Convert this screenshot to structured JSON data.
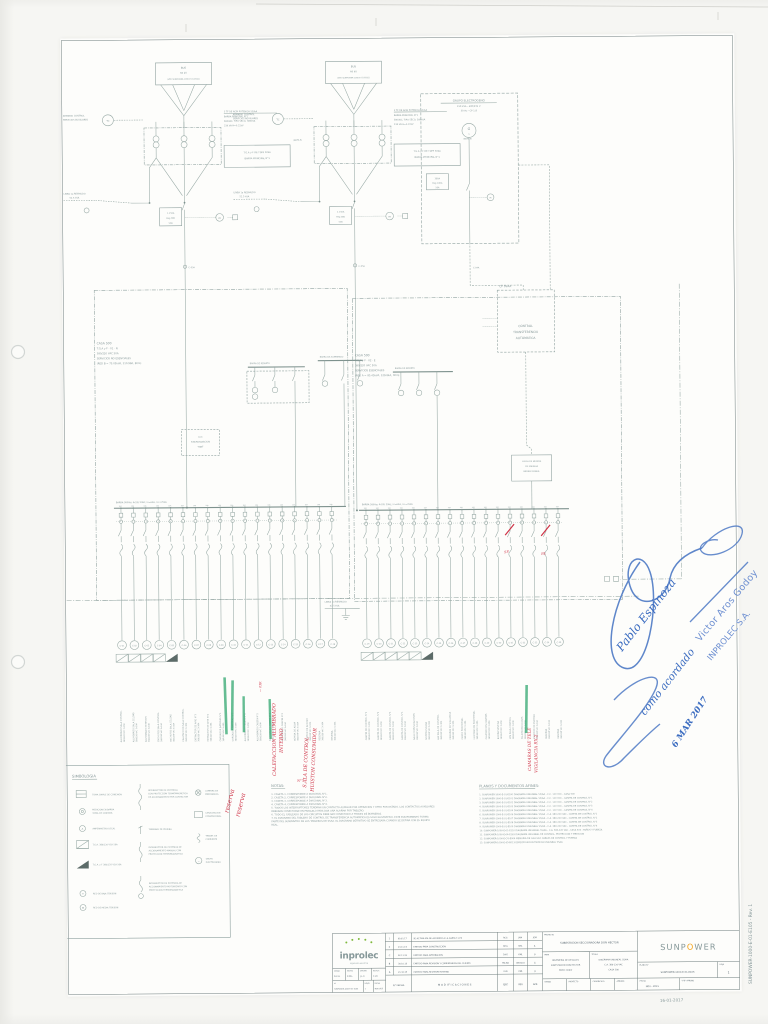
{
  "meta": {
    "corner_date": "16-01-2017",
    "side_code": "SUNPOWER-1000-E-01-E105  -  Rev. 1"
  },
  "tx": {
    "bus1": "BUS",
    "bus2": "66 kV",
    "bus3": "(VER SUNPOWER-1000-E-01-E001)",
    "ctrl1": "ARMARIO CONTROL",
    "ctrl2": "SERVICIOS AUXILIARES",
    "tc": "TC",
    "r1": "3 TF DE ALTA POTENCIA SS/AA",
    "r2": "BARRA PRINCIPAL N°1",
    "r3": "380VAC, TIPO SECO, 380kVA",
    "r4": "23K VA  H=0.22kV",
    "tga1": "T.G.A y F DE TDPF 50kA",
    "tga2": "BARRA PRINCIPAL N°1",
    "nota": "(NOTA 5)",
    "linea1": "LINEA 1a RESPALDO",
    "linea2": "52.5 kVA",
    "meter": "Wh",
    "rating1": [
      "1.150A",
      "Reg 380",
      "50A"
    ],
    "rating2": [
      "2.150A",
      "Reg 380",
      "50A"
    ],
    "tag1": "C-05A",
    "tag2": "C-05A"
  },
  "gen": {
    "l1": "GRUPO ELECTROGENO",
    "l2": "150 kVA - 400/231 V",
    "l3": "50 Hz - CP 1.8",
    "g": "G",
    "wave": "~",
    "rating": [
      "380A",
      "Reg 100A",
      "50A"
    ],
    "meter": "M",
    "tag": "C-04A"
  },
  "cp": {
    "tag": "CP  SSAA",
    "l1": "CONTROL",
    "l2": "TRANSFERENCIA",
    "l3": "AUTOMATICA"
  },
  "panels": {
    "left": {
      "l1": "CASA 500",
      "l2": "T.G.A y F - 01 - N",
      "l3": "380/220 VAC 50A",
      "l4": "SERVICIOS NO ESENCIALES",
      "l5": "(RED B = 73.05kVA, 110.98A, 80m)",
      "bus": "BARRA 380Vac 4x50/ 50Hz, In=63A, Icc=25kA",
      "minibus1": "BARRA DE REPARTO",
      "minibus2": "BARRA DE ALUMBRADO",
      "lcc1": "LCC",
      "lcc2": "SINCRONIZACION",
      "lcc3": "TGBT"
    },
    "right": {
      "l1": "CASA 500",
      "l2": "T.G.A y F - 02 - E",
      "l3": "380/220 VAC 50A",
      "l4": "SERVICIOS ESENCIALES",
      "l5": "(RED A = 85.45kVA, 129.84A, 30m)",
      "bus": "BARRA 380Vac 4x50/ 50Hz, In=63A, Icc=25kA",
      "minibus1": "BARRA DE REPARTO",
      "med1": "LLEGA DE MEDIDA",
      "med2": "DE ENERGIA",
      "med3": "BIDIRECCIONAL"
    },
    "bypass1": "LINEA 1a RESPALDO",
    "bypass2": "52.5 kVA"
  },
  "feeders": {
    "volt": "380/220 VAC 3x10A",
    "tap": "10A",
    "left": [
      [
        "C-01",
        "ALUMBRADO SALA CONTROL"
      ],
      [
        "C-02",
        "ALUMBRADO SALA CELDAS"
      ],
      [
        "C-03",
        "ALUMBRADO EXTERIOR"
      ],
      [
        "C-04",
        "ENCHUFES SALA CONTROL"
      ],
      [
        "C-05",
        "ENCHUFES SALA CELDAS"
      ],
      [
        "C-06",
        "CALEFACCION SALA CONTROL"
      ],
      [
        "C-07",
        "EXTRACTOR DE AIRE N°1"
      ],
      [
        "C-08",
        "EXTRACTOR DE AIRE N°2"
      ],
      [
        "C-09",
        "CARGADOR BATERIAS N°1"
      ],
      [
        "C-10",
        "CARGADOR BATERIAS N°2"
      ],
      [
        "C-11",
        "ALUMBRADO CASETA N°1"
      ],
      [
        "C-12",
        "ALUMBRADO CASETA N°2"
      ],
      [
        "C-13",
        "ALUMBRADO CASETA N°3"
      ],
      [
        "C-14",
        "ALUMBRADO CASETA N°4"
      ],
      [
        "C-15",
        "BOMBA DE AGUA"
      ],
      [
        "C-16",
        "PORTON DE ACCESO"
      ],
      [
        "C-17",
        "RESERVA"
      ],
      [
        "C-18",
        "RESERVA"
      ]
    ],
    "right": [
      [
        "C-19",
        "CASETA DE CONTROL N°1"
      ],
      [
        "C-20",
        "CASETA DE CONTROL N°2"
      ],
      [
        "C-21",
        "CASETA DE CONTROL N°3"
      ],
      [
        "C-22",
        "CASETA DE CONTROL N°4"
      ],
      [
        "C-23",
        "SALA COMUNICACIONES"
      ],
      [
        "C-24",
        "SISTEMA SCADA"
      ],
      [
        "C-25",
        "A/A SALA DE CONTROL"
      ],
      [
        "C-26",
        "CAMARAS DE VIGILANCIA"
      ],
      [
        "C-27",
        "CERCO PERIMETRAL"
      ],
      [
        "C-28",
        "ILUMINACION PERIMETRAL"
      ],
      [
        "C-29",
        "CALEFACCION CASETAS"
      ],
      [
        "C-30",
        "BOMBA SENTINA"
      ],
      [
        "C-31",
        "UPS SALA CONTROL"
      ],
      [
        "C-32",
        "TELEPROTECCIONES"
      ],
      [
        "C-33",
        "MEDIDOR DE ENERGIA"
      ],
      [
        "C-34",
        "RESERVA"
      ],
      [
        "C-35",
        "RESERVA"
      ]
    ]
  },
  "legend": {
    "title": "SIMBOLOGIA",
    "items": [
      {
        "lines": [
          "TOMA SIMPLE DE CONEXION"
        ]
      },
      {
        "lines": [
          "MEDICION EN BARRA",
          "TOMA DE CONTROL"
        ]
      },
      {
        "lines": [
          "AMPERIMETRO LOCAL"
        ]
      },
      {
        "lines": [
          "T.G.A. 380/220 VCA 50A"
        ]
      },
      {
        "lines": [
          "T.G.A. y F 380/220 VCA 50A"
        ]
      },
      {
        "lines": [
          "RED DE BAJA TENSION"
        ]
      },
      {
        "lines": [
          "RED DE MEDIA TENSION"
        ]
      },
      {
        "lines": [
          "INTERRUPTOR DE POTENCIA",
          "CON PROTECCION TERMOMAGNETICA",
          "DE ACCIONAMIENTO POR CONTACTOR"
        ]
      },
      {
        "lines": [
          "TERMINAL DE PRUEBA"
        ]
      },
      {
        "lines": [
          "INTERRUPTOR DE POTENCIA DE",
          "ACCIONAMIENTO MANUAL CON",
          "PROTECCION TERMOMAGNETICA"
        ]
      },
      {
        "lines": [
          "INTERRUPTOR DE POTENCIA DE",
          "ACCIONAMIENTO MOTORIZADO CON",
          "PROTECCION TERMOMAGNETICA"
        ]
      },
      {
        "lines": [
          "LAMPARA DE",
          "EMERGENCIA"
        ]
      },
      {
        "lines": [
          "CANALIZACION",
          "CONVENCIONAL"
        ]
      },
      {
        "lines": [
          "TRANSF. DE",
          "CORRIENTE"
        ]
      },
      {
        "lines": [
          "GRUPO",
          "ELECTROGENO"
        ]
      }
    ]
  },
  "notes": {
    "title": "NOTAS:",
    "lines": [
      "1.  CASETA 1, CORRESPONDE A DIAGONAL N°1.",
      "2.  CASETA 2, CORRESPONDE A DIAGONAL N°2.",
      "3.  CASETA 3, CORRESPONDE A DIAGONAL N°3.",
      "4.  CASETA 4, CORRESPONDE A DIAGONAL N°4.",
      "5.  TODOS LOS INTERRUPTORES TENDRAN UN CONTACTO AUXILIAR POR OPERACION Y OTRO POR ESTADO. LOS CONTACTOS AUXILIARES",
      "     DEBERAN CONECTARSE EN PARALELO PARA DAR UNA ALARMA POR TABLERO.",
      "6.  TODO EL CABLEADO DE LOS CIRCUITOS DEBE SER CONECTADO A TRAVES DE BORNERAS.",
      "7.  EL DIAGRAMA DEL TABLERO DE CONTROL DE TRANSFERENCIA AUTOMATICA ES SOLO ILUSTRATIVO. ESTE EQUIPAMIENTO FORMA",
      "     PARTE DEL SUMINISTRO DE LOS TABLEROS DE SSAA. EL DIAGRAMA DEFINITIVO SE ENTREGARA CUANDO SE DEFINA CON EL EQUIPO",
      "     REAL."
    ]
  },
  "planos": {
    "title": "PLANOS Y DOCUMENTOS AFINES:",
    "lines": [
      "1.   SUNPOWER-1000-E-01-E100   DIAGRAMA UNILINEAL SS/AA - C.C. 110 VCC - CASA 500",
      "2.   SUNPOWER-1000-E-01-E101   DIAGRAMA UNILINEAL SS/AA - C.C. 110 VCC - CASETA DE CONTROL N°1",
      "3.   SUNPOWER-1000-E-01-E102   DIAGRAMA UNILINEAL SS/AA - C.C. 110 VCC - CASETA DE CONTROL N°2",
      "4.   SUNPOWER-1000-E-01-E103   DIAGRAMA UNILINEAL SS/AA - C.C. 110 VCC - CASETA DE CONTROL N°3",
      "5.   SUNPOWER-1000-E-01-E104   DIAGRAMA UNILINEAL SS/AA - C.C. 110 VCC - CASETA DE CONTROL N°4",
      "6.   SUNPOWER-1000-E-01-E106   DIAGRAMA UNILINEAL SS/AA - C.A. 380-220 VAC - CASETA DE CONTROL N°1",
      "7.   SUNPOWER-1000-E-01-E107   DIAGRAMA UNILINEAL SS/AA - C.A. 380-220 VAC - CASETA DE CONTROL N°2",
      "8.   SUNPOWER-1000-E-01-E108   DIAGRAMA UNILINEAL SS/AA - C.A. 380-220 VAC - CASETA DE CONTROL N°3",
      "9.   SUNPOWER-1000-E-01-E109   DIAGRAMA UNILINEAL SS/AA - C.A. 380-220 VAC - CASETA DE CONTROL N°4",
      "10. SUNPOWER-1000-E-01-E110   DIAGRAMA UNILINEAL SS/AA - C.A. 380-220 VAC - CASA 500 - PAÑOS Y FUERZA",
      "11. SUNPOWER-1000-E-04-E163   DIAGRAMA UNILINEAL DE CONTROL, PROTECCION Y MEDICION",
      "12. SUNPOWER-1000-E-CG-E004   MEMORIA DE CALCULO CABLES DE CONTROL Y FUERZA",
      "13. SUNPOWER-1000-E-05-E013   ESPECIFICACION TECNICA UNILINEAL SSAA"
    ]
  },
  "titleblock": {
    "revisions": [
      {
        "n": "1",
        "fecha": "09.01.17",
        "desc": "SE ACTUALIZA DE ACUERDO A LA CARTA T-229",
        "ejec": "RCG",
        "rev": "JAM",
        "apr": "JGM"
      },
      {
        "n": "0",
        "fecha": "23.11.15",
        "desc": "EMITIDO PARA CONSTRUCCION",
        "ejec": "DHG",
        "rev": "KML",
        "apr": "JL"
      },
      {
        "n": "C",
        "fecha": "02.11.15",
        "desc": "EMITIDO PARA APROBACION",
        "ejec": "DHG",
        "rev": "KML",
        "apr": "JL"
      },
      {
        "n": "B",
        "fecha": "30.10.15",
        "desc": "EMITIDO PARA REVISION Y COMENTARIOS DEL CLIENTE",
        "ejec": "PALMA",
        "rev": "ANGULO",
        "apr": "JL"
      },
      {
        "n": "A",
        "fecha": "21.10.15",
        "desc": "EMITIDO PARA REVISION INTERNA",
        "ejec": "KLB",
        "rev": "KML",
        "apr": "JL"
      }
    ],
    "header": {
      "nf": "N°  FECHA",
      "mod": "M O D I F I C A C I O N E S",
      "ejec": "EJEC",
      "rev": "REV",
      "apr": "APR"
    },
    "proyecto_label": "PROYECTO",
    "proyecto": "SUBESTACION SECCIONADORA DON HECTOR",
    "para_label": "PARA",
    "para1": "INGENIERIA DE DETALLES",
    "para2": "SUBESTACION DON HECTOR",
    "para3": "PATIO 220kV",
    "titulo_label": "TITULO",
    "titulo1": "DIAGRAMA UNILINEAL SS/AA",
    "titulo2": "C.A. 380-220 VAC",
    "titulo3": "CASA 500",
    "bl1": "DIBUJO",
    "bl2": "PROYECTO",
    "bl3": "CUADRICULA",
    "bl4": "APROBO",
    "plano_label": "PLANO N°",
    "plano": "SUNPOWER-1000-E-01-E105",
    "hoja_label": "HOJA",
    "hoja": "1",
    "fecha_label": "FECHA",
    "fecha": "NOV - 2015",
    "vb_label": "V°B° APROBO",
    "mini": [
      {
        "l": "DIBUJO",
        "v": "R.C.G."
      },
      {
        "l": "REVISO",
        "v": "K.M.L."
      },
      {
        "l": "APROBO",
        "v": "J.L.C."
      },
      {
        "l": "ESCALA",
        "v": "1:20"
      }
    ],
    "mini2": [
      {
        "l": "N°",
        "v": "SUNPOWER-1000-E-01-E105"
      },
      {
        "l": "HOJAS",
        "v": "1"
      },
      {
        "l": "FECHA",
        "v": "NOV.2015"
      }
    ]
  },
  "logos": {
    "inprolec": "inprolec",
    "inprolec_tag": "ingenieria electrica",
    "sun_a": "SUNP",
    "sun_o": "O",
    "sun_b": "WER"
  },
  "red": {
    "res1": "reserva",
    "res2": "reserva",
    "cal1": "CALEFACCION ALUMBRADO",
    "cal2": "INTERNO",
    "tag": "— 03R",
    "sala1": "S.ALA DE CONTROL",
    "sala2": "HUISTON CONSUMIDOR",
    "cam1": "CAMARAS DE TELE",
    "cam2": "VIGILANCIA RX-2",
    "sp": "SP.",
    "bl": "BL",
    "n7": "N°7"
  },
  "stamp": {
    "hand1": "Pablo Espinoza",
    "hand2": "como acordado",
    "name": "Victor Aros Godoy",
    "company": "INPROLEC  S.A.",
    "date": "6 MAR 2017"
  }
}
